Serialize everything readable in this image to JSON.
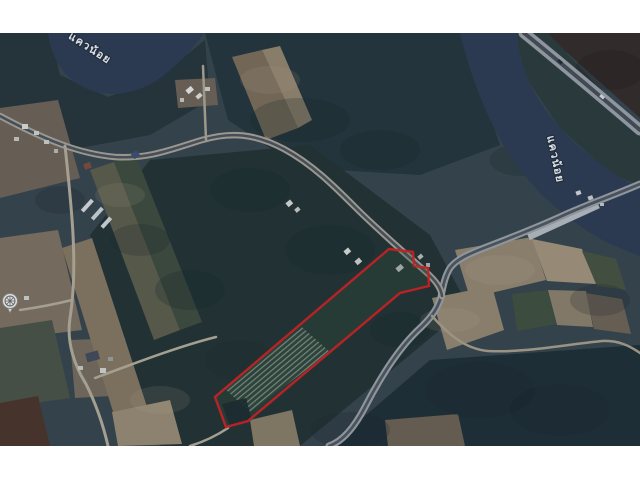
{
  "frame": {
    "background": "#ffffff",
    "image_region": {
      "x": 0,
      "y": 33,
      "width": 640,
      "height": 413
    }
  },
  "map": {
    "kind": "satellite-imagery",
    "river_labels": [
      {
        "text": "แควน้อย",
        "x": 88,
        "y": 51,
        "rotate": 33
      },
      {
        "text": "แควน้อย",
        "x": 552,
        "y": 160,
        "rotate": 78
      }
    ],
    "parcel": {
      "points": "389,249 413,252 414,266 428,268 429,286 400,293 248,421 226,427 215,397",
      "outline_color": "#d42020"
    },
    "poi_marker": {
      "name": "temple-marker",
      "x": 10,
      "y": 301
    },
    "palette": {
      "water": "#2d3a52",
      "forest_dark": "#223231",
      "forest_blue": "#1e2d35",
      "field_tan": "#8c7e68",
      "road_light": "#a8a296",
      "road_asphalt": "#4a515b",
      "label_text": "#eef2f6"
    }
  }
}
